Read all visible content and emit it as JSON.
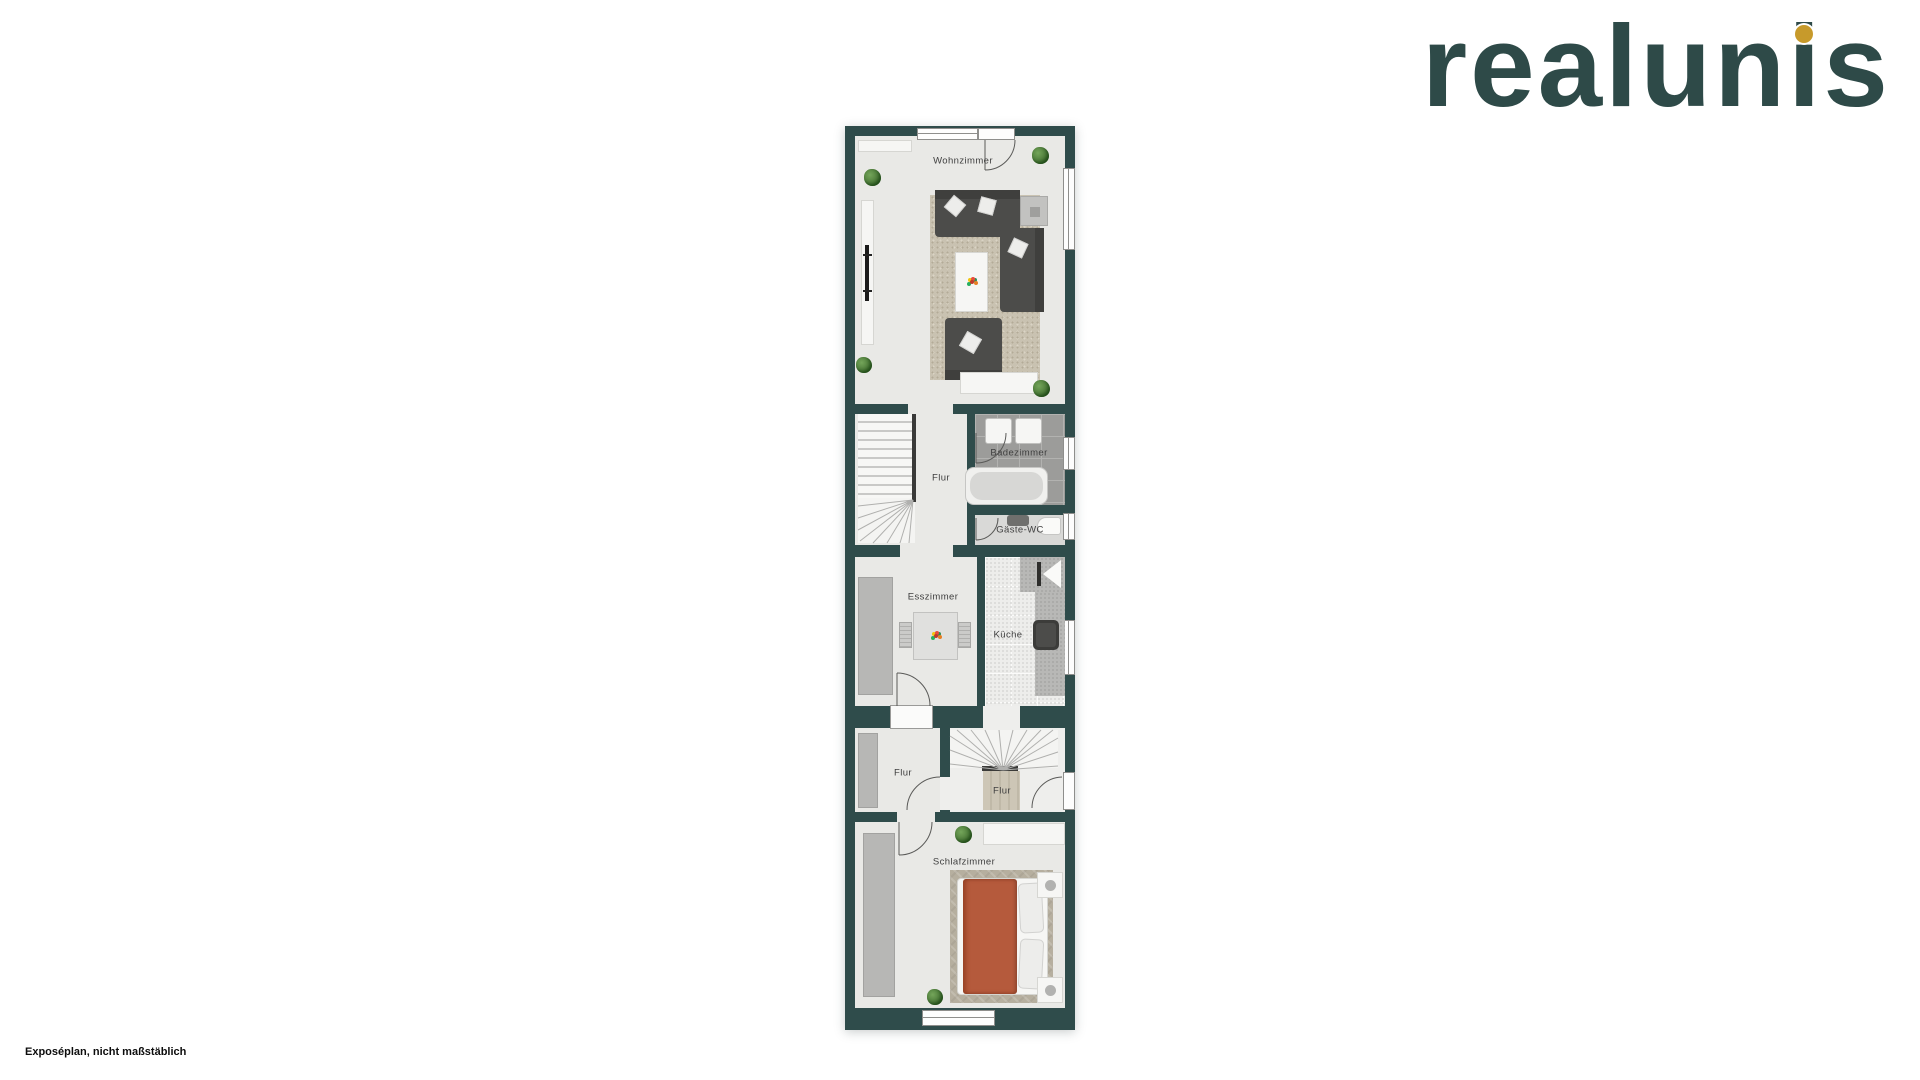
{
  "logo": {
    "text": "realunis",
    "color": "#2e4a48",
    "dot_color": "#c79a2b"
  },
  "caption": {
    "text": "Exposéplan, nicht maßstäblich"
  },
  "floorplan": {
    "rooms": {
      "wohnzimmer": {
        "label": "Wohnzimmer"
      },
      "flur_mitte": {
        "label": "Flur"
      },
      "badezimmer": {
        "label": "Badezimmer"
      },
      "gaeste_wc": {
        "label": "Gäste-WC"
      },
      "esszimmer": {
        "label": "Esszimmer"
      },
      "kueche": {
        "label": "Küche"
      },
      "flur_unten": {
        "label": "Flur"
      },
      "flur_eingang": {
        "label": "Flur"
      },
      "schlafzimmer": {
        "label": "Schlafzimmer"
      }
    },
    "colors": {
      "wall": "#2f4c4b",
      "floor": "#e9e9e6",
      "bath_tile": "#9c9c9a",
      "living_rug": "#c9c2b1",
      "bedroom_rug": "#b6af9f",
      "sofa": "#4c4c4a",
      "bed_duvet": "#b55a3c",
      "kitchen_counter": "#b8b8b6",
      "wardrobe": "#b7b7b5",
      "plant": "#4c7a38"
    }
  }
}
